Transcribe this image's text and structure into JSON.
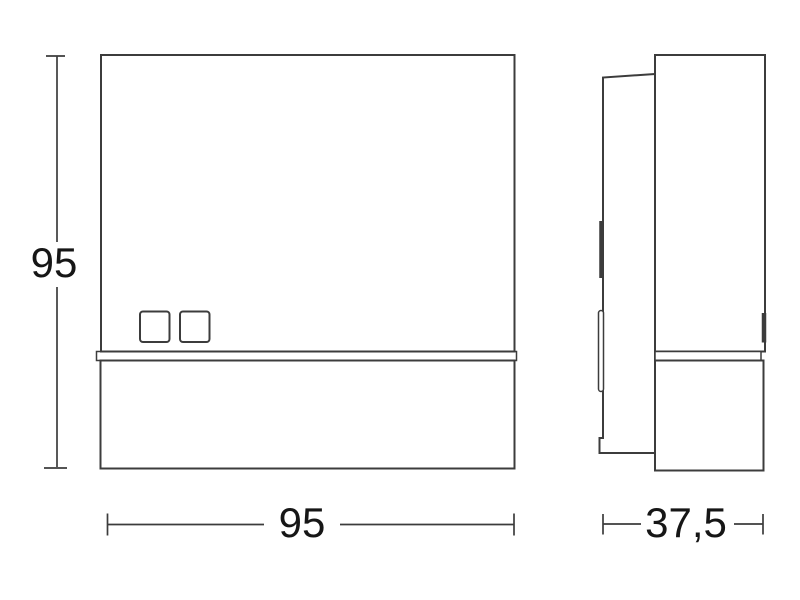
{
  "drawing": {
    "kind": "product-dimension-drawing",
    "dim_height_label": "95",
    "dim_width_label": "95",
    "dim_depth_label": "37,5",
    "colors": {
      "line": "#3c3c3c",
      "text": "#161616",
      "background": "#ffffff"
    }
  }
}
